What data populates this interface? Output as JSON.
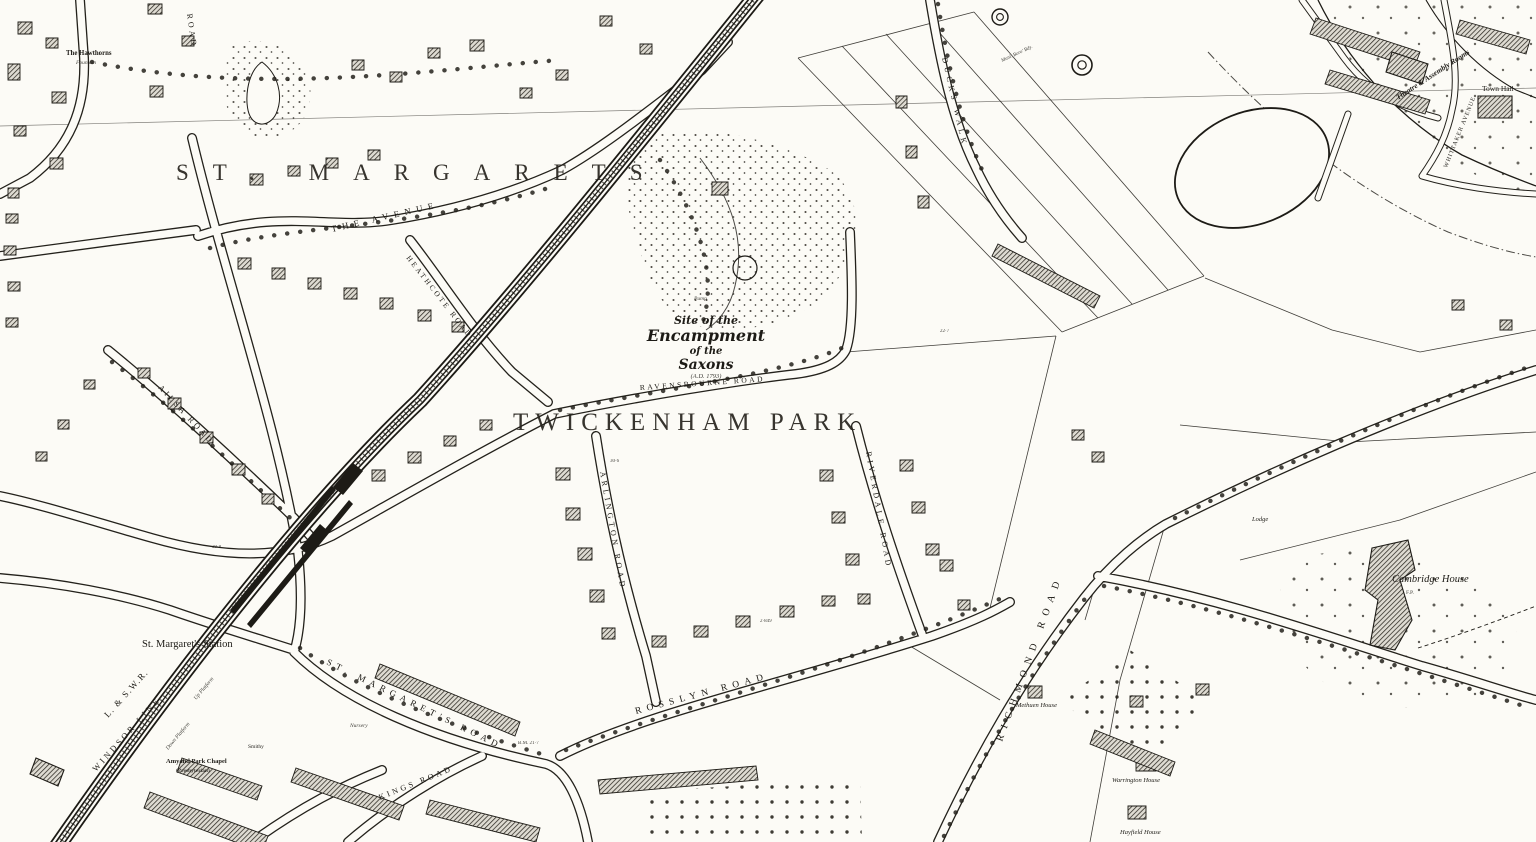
{
  "map_title": "St. Margaret's and Twickenham Park — Ordnance Survey style town plan",
  "colors": {
    "paper": "#fcfbf6",
    "ink": "#1d1b16"
  },
  "district_labels": {
    "st_margarets": "ST. MARGARETS",
    "twickenham_park": "TWICKENHAM PARK"
  },
  "antiquity_note": {
    "line1": "Site of the",
    "line2": "Encampment",
    "line3": "of the",
    "line4": "Saxons",
    "line5": "(A.D. 1793)"
  },
  "streets": {
    "ravensbourne_road": "RAVENSBOURNE ROAD",
    "arlington_road": "ARLINGTON ROAD",
    "riverdale_road": "RIVERDALE ROAD",
    "rosslyn_road": "ROSSLYN ROAD",
    "richmond_road": "RICHMOND ROAD",
    "st_margarets_road": "ST. MARGARET'S ROAD",
    "kings_road": "KINGS ROAD",
    "heathcote_road": "HEATHCOTE ROAD",
    "ailsa_road": "AILSA ROAD",
    "the_avenue": "THE AVENUE",
    "ducks_walk": "DUCKS WALK",
    "whittaker_avenue": "WHITTAKER AVENUE",
    "road_partial": "ROAD"
  },
  "railway": {
    "company": "L. & S.W.R.",
    "line_name": "WINDSOR LINE",
    "station": "St. Margaret's Station",
    "up_platform": "Up Platform",
    "down_platform": "Down Platform"
  },
  "places": {
    "the_hawthorns": "The Hawthorns",
    "fountain": "Fountain",
    "pump": "Pump",
    "cambridge_house": "Cambridge House",
    "footpath_abbrev": "F.P.",
    "town_hall": "Town Hall",
    "theatre_assembly_rooms": "Theatre & Assembly Rooms",
    "amyand_park_chapel": "Amyand Park Chapel",
    "amyand_park_chapel_note": "(Presbyterian)",
    "smithy": "Smithy",
    "nursery": "Nursery",
    "methuen_house": "Methuen House",
    "warrington_house": "Warrington House",
    "hayfield_house": "Hayfield House",
    "lodge": "Lodge",
    "boundary_note": "Munl. Boro' Bdy."
  },
  "survey_annotations": {
    "a1": "39·8",
    "a2": "30·6",
    "a3": "2·849",
    "a4": "B.M. 21·7",
    "a5": "22·7"
  }
}
